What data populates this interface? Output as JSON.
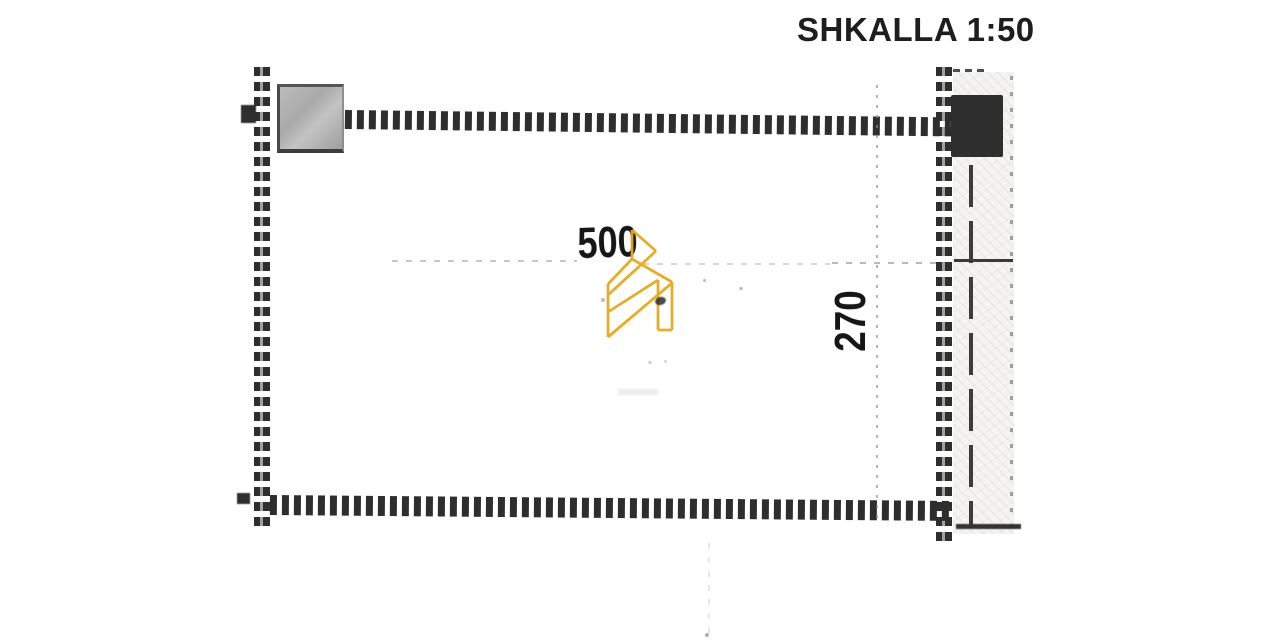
{
  "header": {
    "scale_label": "SHKALLA 1:50"
  },
  "drawing": {
    "dimensions": {
      "width_label": "500",
      "height_label": "270"
    },
    "elements": {
      "left_wall": "dashed-wall",
      "top_wall": "dashed-wall",
      "bottom_wall": "dashed-wall",
      "right_wall": "dashed-wall",
      "gray_block": "hatched-square-block",
      "dark_block": "solid-dark-square-block",
      "side_band": "speckled-strip-with-dash-dot-line"
    },
    "watermark": {
      "icon": "gold-ribbon-building-logo-icon",
      "color": "#E6A91F"
    },
    "colors": {
      "wall_dark": "#2e2e2e",
      "gray_block_fill": "#b0b0b0",
      "dark_block_fill": "#2e2e2e",
      "band_fill": "#f5f4f1",
      "faint_guide": "#8d8d8d",
      "text": "#1e1e1e",
      "background": "#ffffff"
    }
  }
}
